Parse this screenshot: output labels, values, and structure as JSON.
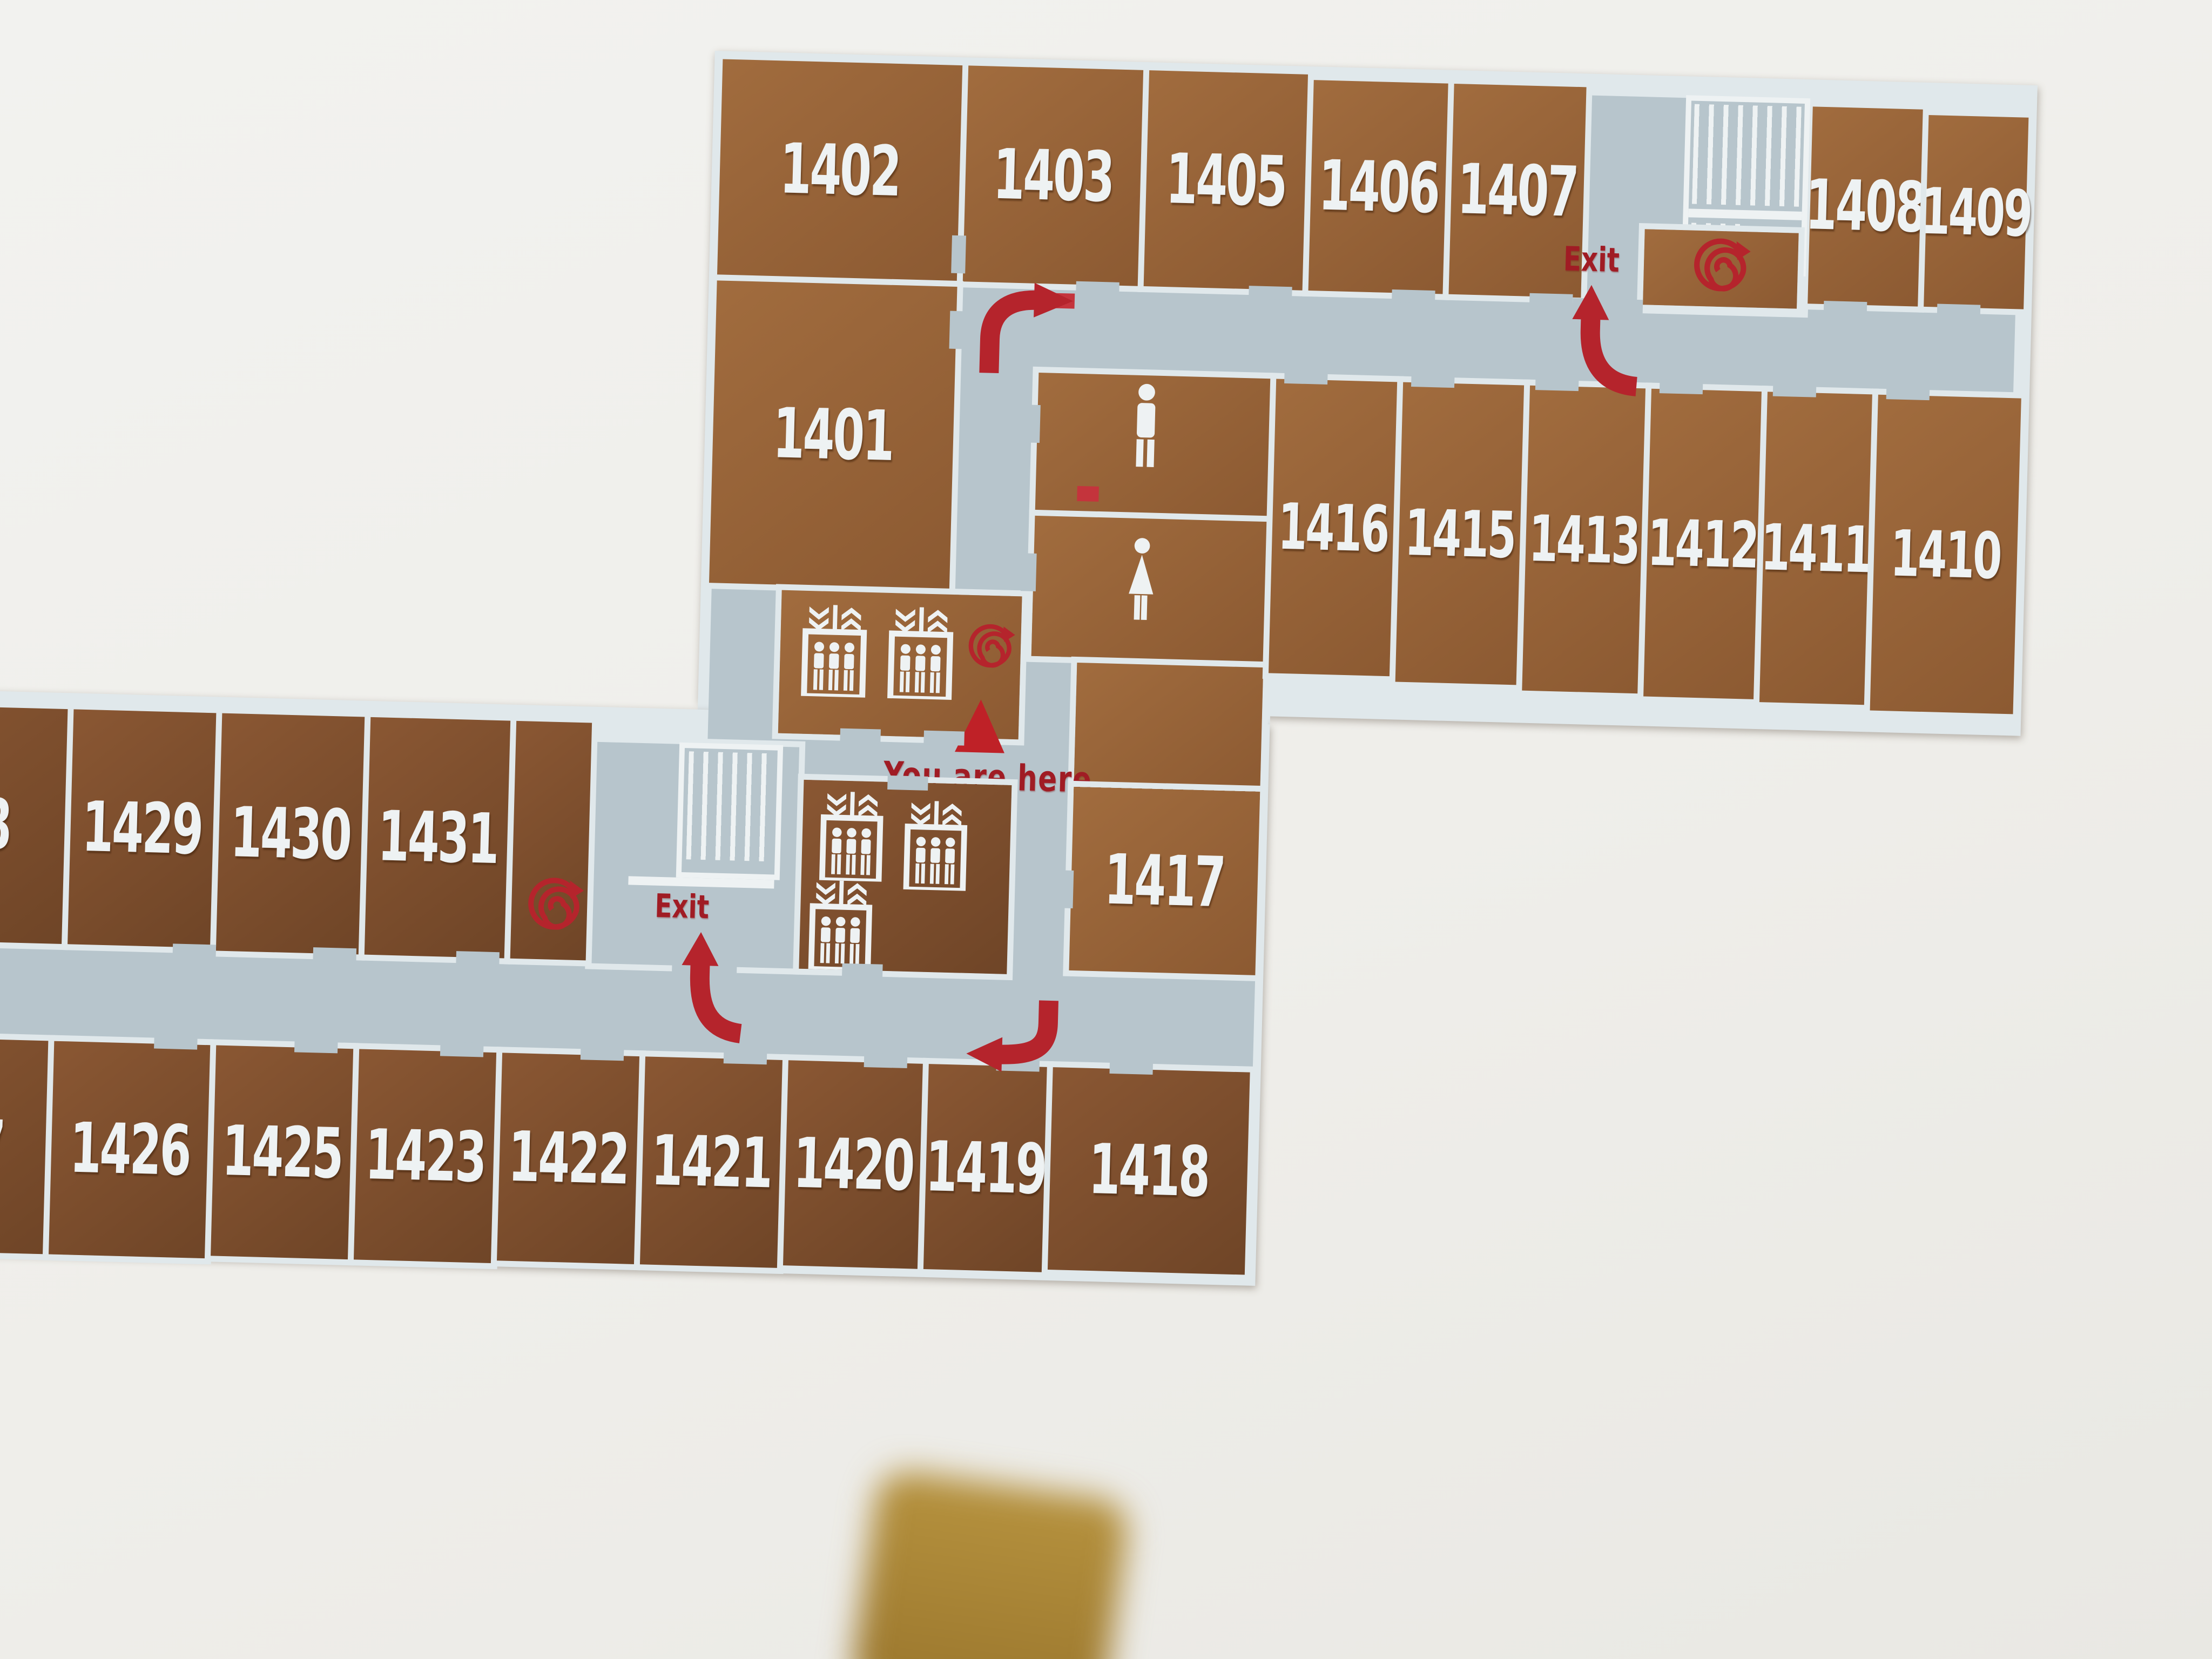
{
  "map_sign": {
    "you_are_here_label": "You are here",
    "exit_labels": {
      "upper": "Exit",
      "lower": "Exit"
    },
    "rooms": {
      "r1401": "1401",
      "r1402": "1402",
      "r1403": "1403",
      "r1405": "1405",
      "r1406": "1406",
      "r1407": "1407",
      "r1408": "1408",
      "r1409": "1409",
      "r1410": "1410",
      "r1411": "1411",
      "r1412": "1412",
      "r1413": "1413",
      "r1415": "1415",
      "r1416": "1416",
      "r1417": "1417",
      "r1418": "1418",
      "r1419": "1419",
      "r1420": "1420",
      "r1421": "1421",
      "r1422": "1422",
      "r1423": "1423",
      "r1425": "1425",
      "r1426": "1426",
      "r1429": "1429",
      "r1430": "1430",
      "r1431": "1431"
    },
    "partial_room_digits": {
      "upper_left_edge": "8",
      "lower_left_edge": "7"
    },
    "icons": {
      "elevator": "elevator-car-with-passengers",
      "male_restroom": "male-figure",
      "female_restroom": "female-figure",
      "fire_hose_reel": "red-spiral",
      "route_arrow": "red-curved-arrow",
      "stairs": "stair-treads"
    },
    "colors": {
      "wall": "#f0efec",
      "map_lines": "#e0e8eb",
      "corridor_gray": "#b7c5cc",
      "room_brown_upper": "#9a6538",
      "room_brown_lower": "#7b4d2b",
      "route_red": "#b5242c",
      "label_white": "#eef2f3"
    }
  }
}
